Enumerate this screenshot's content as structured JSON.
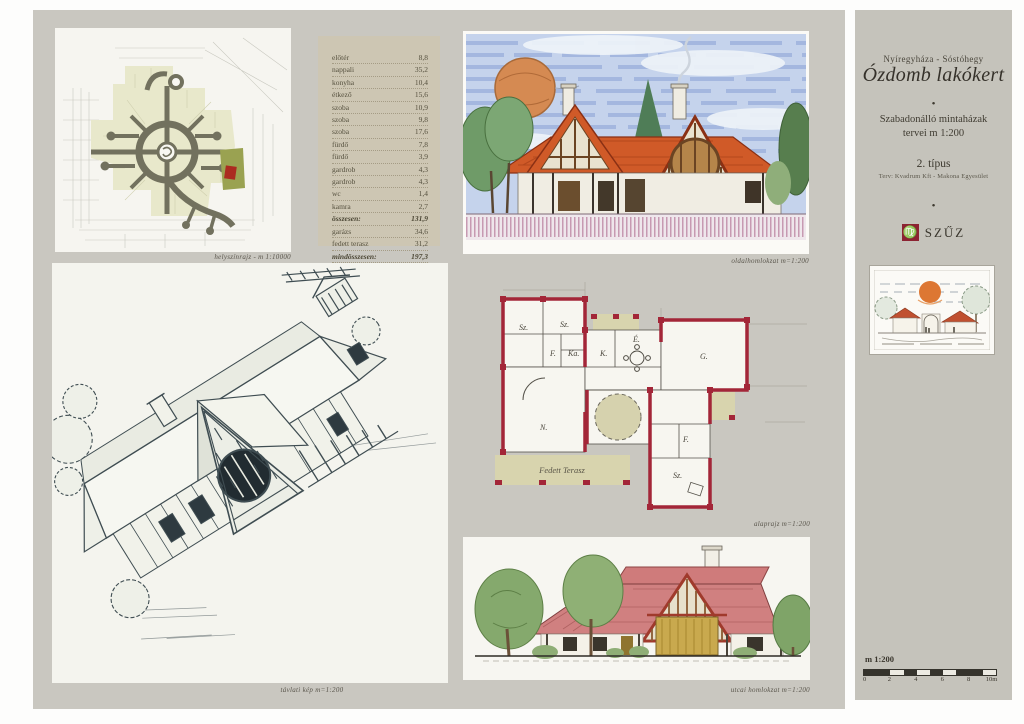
{
  "board": {
    "site_plan": {
      "caption": "helyszínrajz - m 1:10000"
    },
    "area_table": {
      "rows": [
        {
          "label": "előtér",
          "value": "8,8"
        },
        {
          "label": "nappali",
          "value": "35,2"
        },
        {
          "label": "konyha",
          "value": "10,4"
        },
        {
          "label": "étkező",
          "value": "15,6"
        },
        {
          "label": "szoba",
          "value": "10,9"
        },
        {
          "label": "szoba",
          "value": "9,8"
        },
        {
          "label": "szoba",
          "value": "17,6"
        },
        {
          "label": "fürdő",
          "value": "7,8"
        },
        {
          "label": "fürdő",
          "value": "3,9"
        },
        {
          "label": "gardrob",
          "value": "4,3"
        },
        {
          "label": "gardrob",
          "value": "4,3"
        },
        {
          "label": "wc",
          "value": "1,4"
        },
        {
          "label": "kamra",
          "value": "2,7"
        },
        {
          "label": "összesen:",
          "value": "131,9"
        },
        {
          "label": "garázs",
          "value": "34,6"
        },
        {
          "label": "fedett terasz",
          "value": "31,2"
        },
        {
          "label": "mindösszesen:",
          "value": "197,3"
        }
      ]
    },
    "side_elevation": {
      "caption": "oldalhomlokzat  m=1:200"
    },
    "axonometric": {
      "caption": "távlati kép  m=1:200"
    },
    "floor_plan": {
      "caption": "alaprajz  m=1:200",
      "terrace_label": "Fedett Terasz",
      "room_labels": {
        "r1": "Sz.",
        "r2": "Sz.",
        "r3": "F.",
        "r4": "Ka.",
        "r5": "K.",
        "r6": "É.",
        "r7": "G.",
        "r8": "N.",
        "r9": "F.",
        "r10": "Sz."
      }
    },
    "street_elevation": {
      "caption": "utcai homlokzat  m=1:200"
    }
  },
  "sidebar": {
    "location": "Nyíregyháza - Sóstóhegy",
    "title": "Ózdomb lakókert",
    "bullet": "•",
    "subtitle_line1": "Szabadonálló mintaházak",
    "subtitle_line2": "tervei  m 1:200",
    "type_label": "2. típus",
    "credit": "Terv: Kvadrum Kft - Makona Egyesület",
    "logo_glyph": "♍",
    "logo_text": "SZŰZ",
    "scale": {
      "label": "m 1:200",
      "ticks": [
        "0",
        "2",
        "4",
        "6",
        "8",
        "10m"
      ]
    }
  },
  "colors": {
    "board_gray": "#c9c7c0",
    "sidebar_gray": "#c5c3bb",
    "panel_white": "#f6f5f0",
    "table_tan": "#cdc6b3",
    "plan_wall_red": "#a32638",
    "terrace_olive": "#d8d4ae",
    "roof_orange": "#d05a28",
    "roof_pink": "#d08080",
    "sky_blue": "#c5d3ec",
    "logo_red": "#8c2332",
    "site_area_green": "#e8e8cb",
    "site_road_gray": "#72715e",
    "highlight_parcel": "#9aa251",
    "highlight_lot_red": "#ab2b20"
  }
}
